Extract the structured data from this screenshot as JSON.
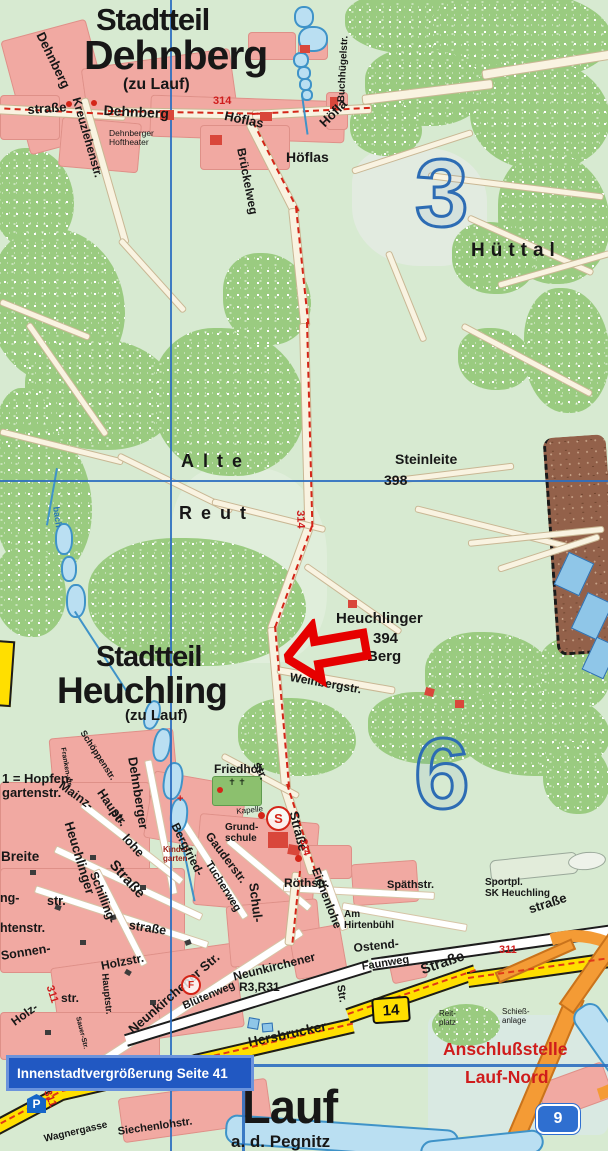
{
  "titles": {
    "dehnberg_l1": "Stadtteil",
    "dehnberg_l2": "Dehnberg",
    "dehnberg_l3": "(zu Lauf)",
    "heuchling_l1": "Stadtteil",
    "heuchling_l2": "Heuchling",
    "heuchling_l3": "(zu Lauf)",
    "lauf": "Lauf",
    "lauf_suffix": "a. d. Pegnitz"
  },
  "grid": {
    "num3": "3",
    "num6": "6"
  },
  "areas": {
    "huettal": "Hüttal",
    "alte": "Alte",
    "reut": "Reut",
    "steinleite": "Steinleite",
    "steinleite_elev": "398",
    "heuchlinger": "Heuchlinger",
    "berg_elev": "394",
    "berg": "Berg",
    "hoeflas_place": "Höflas",
    "breite": "Breite",
    "sonnen": "Sonnen-"
  },
  "streets": {
    "dehnberg_nw": "Dehnberg",
    "strasse_w": "straße",
    "kreuzlehenstr": "Kreuzlehenstr.",
    "dehnberg_road": "Dehnberg",
    "hoeflas_road1": "Höflas",
    "hoeflas_road2": "Höfla",
    "brueckelweg": "Brückelweg",
    "buchhuegelstr": "Buchhügelstr.",
    "weinbergstr": "Weinbergstr.",
    "bach": "bach",
    "schoeppenstr": "Schöppenstr.",
    "frankenstr": "Franken-str.",
    "mainz": "Mainz-",
    "haupt": "Haupt-",
    "str1": "str.",
    "dehnberger_v": "Dehnberger",
    "heuchlinger_v": "Heuchlinger",
    "lohe": "lohe",
    "strasse1": "Straße",
    "str2": "str.",
    "ng": "ng-",
    "schilling": "Schilling-",
    "strasse2": "straße",
    "htenstr": "htenstr.",
    "bergfried": "Bergfried-",
    "gauderstr": "Gauderstr.",
    "tucherweg": "Tucherweg",
    "str3": "str.",
    "strasse314": "Straße",
    "schul": "Schul-",
    "roethstr": "Röthstr.",
    "eichenlohe": "Eichenlohe",
    "spaethstr": "Späthstr.",
    "am_hirtenbuehl": "Am\nHirtenbühl",
    "strasse3": "straße",
    "ostend": "Ostend-",
    "faunweg": "Faunweg",
    "neunkirchener_str": "Neunkirchener Str.",
    "neunkirchener2": "Neunkirchener",
    "bluetenweg": "Blütenweg",
    "holzstr": "Holzstr.",
    "holz": "Holz-",
    "str4": "str.",
    "hauptstr_v": "Hauptstr.",
    "sauerstr": "Sauer-Str.",
    "hersbrucker": "Hersbrucker",
    "strasse_b14": "Straße",
    "str5": "Str.",
    "siechenlohstr": "Siechenlohstr.",
    "wagnergasse": "Wagnergasse"
  },
  "pois": {
    "hoftheater": "Dehnberger\nHoftheater",
    "hopfen_note": "1 = Hopfen-\ngartenstr.",
    "kindergarten": "Kinder-\ngarten",
    "friedhof": "Friedhof",
    "kapelle": "Kapelle",
    "grundschule": "Grund-\nschule",
    "sportplatz": "Sportpl.\nSK Heuchling",
    "reitplatz": "Reit-\nplatz",
    "schiessanlage": "Schieß-\nanlage",
    "anschlussstelle": "Anschlußstelle",
    "lauf_nord": "Lauf-Nord",
    "r3r31": "R3,R31",
    "cem_crosses": "✝ ✝",
    "kiga_cross": "+"
  },
  "road_numbers": {
    "n314": "314",
    "n311": "311",
    "b14": "14",
    "a9": "9"
  },
  "icons": {
    "school_s": "S",
    "parking_p": "P",
    "halt_f": "F"
  },
  "banner": {
    "text": "Innenstadtvergrößerung Seite 41"
  },
  "colors": {
    "forest": "#9acb80",
    "urban_pink": "#f1a9a2",
    "grid_blue": "#2d6cb4",
    "road_red": "#d42518",
    "highway_yellow": "#ffdf00",
    "motorway_orange": "#f49b35",
    "water_blue": "#badff2",
    "banner_blue": "#2158c2",
    "highlight_red": "#cf1c1c"
  }
}
